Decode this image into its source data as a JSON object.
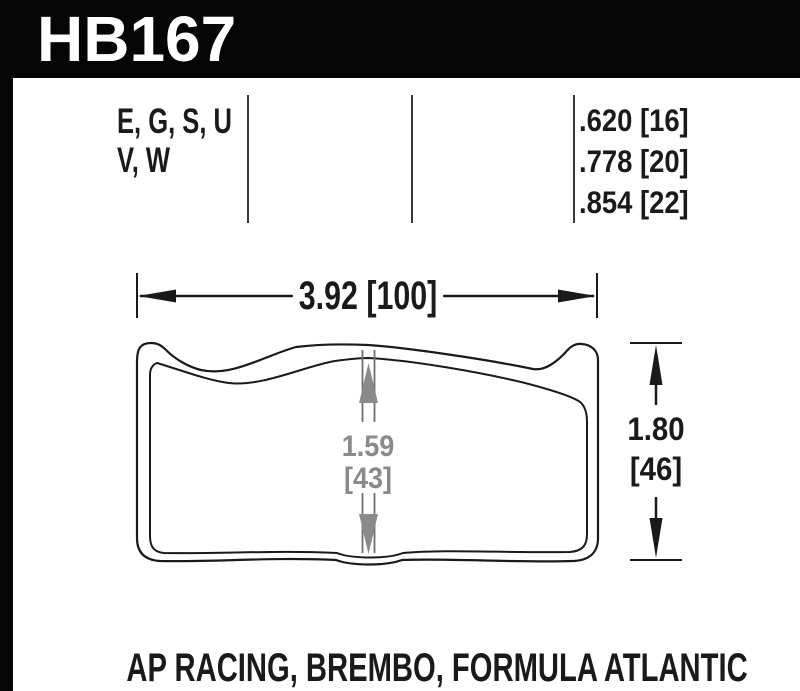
{
  "part": {
    "number": "HB167"
  },
  "spec_table": {
    "compound_codes_line1": "E, G, S, U",
    "compound_codes_line2": "V, W",
    "thicknesses": [
      ".620 [16]",
      ".778 [20]",
      ".854 [22]"
    ]
  },
  "drawing": {
    "width_dimension": "3.92 [100]",
    "center_dimension_value": "1.59",
    "center_dimension_mm": "[43]",
    "height_dimension_value": "1.80",
    "height_dimension_mm": "[46]"
  },
  "applications_label": "AP RACING, BREMBO, FORMULA ATLANTIC",
  "colors": {
    "ink": "#1a1a1a",
    "band": "#050505",
    "dim_gray": "#8a8a8a",
    "rule": "#3a3a3a",
    "background": "#ffffff"
  }
}
